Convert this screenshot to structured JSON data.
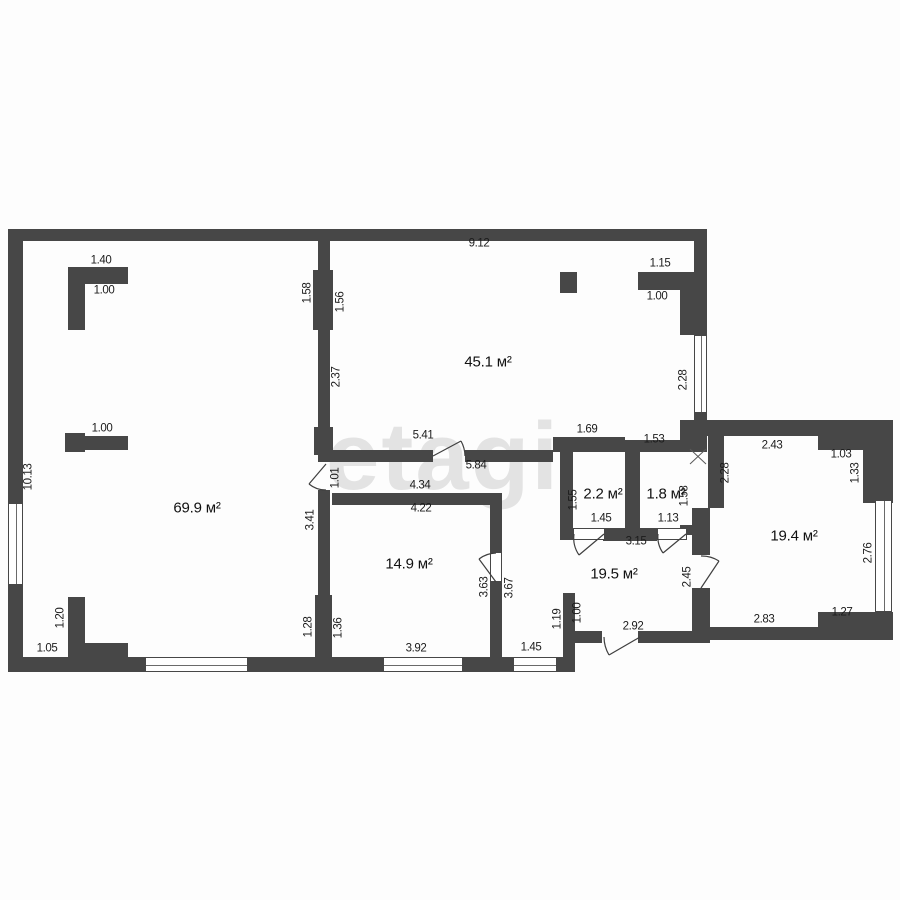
{
  "plan": {
    "wall_color": "#474747",
    "line_color": "#3f3f3f",
    "text_color": "#1c1c1c",
    "background": "#fdfdfd",
    "watermark": {
      "text": "etagi",
      "x": 443,
      "y": 457
    },
    "rooms": [
      {
        "label": "69.9 м²",
        "x": 197,
        "y": 508
      },
      {
        "label": "45.1 м²",
        "x": 488,
        "y": 362
      },
      {
        "label": "14.9 м²",
        "x": 409,
        "y": 564
      },
      {
        "label": "2.2 м²",
        "x": 603,
        "y": 494
      },
      {
        "label": "1.8 м²",
        "x": 666,
        "y": 494
      },
      {
        "label": "19.5 м²",
        "x": 614,
        "y": 574
      },
      {
        "label": "19.4 м²",
        "x": 794,
        "y": 536
      }
    ],
    "dims": [
      {
        "t": "1.40",
        "x": 101,
        "y": 261,
        "r": 0
      },
      {
        "t": "1.00",
        "x": 104,
        "y": 291,
        "r": 0
      },
      {
        "t": "9.12",
        "x": 479,
        "y": 244,
        "r": 0
      },
      {
        "t": "1.15",
        "x": 660,
        "y": 264,
        "r": 0
      },
      {
        "t": "1.00",
        "x": 657,
        "y": 297,
        "r": 0
      },
      {
        "t": "1.00",
        "x": 102,
        "y": 429,
        "r": 0
      },
      {
        "t": "1.69",
        "x": 587,
        "y": 430,
        "r": 0
      },
      {
        "t": "1.53",
        "x": 654,
        "y": 440,
        "r": 0
      },
      {
        "t": "2.43",
        "x": 772,
        "y": 446,
        "r": 0
      },
      {
        "t": "1.03",
        "x": 841,
        "y": 455,
        "r": 0
      },
      {
        "t": "5.41",
        "x": 423,
        "y": 436,
        "r": 0
      },
      {
        "t": "5.84",
        "x": 476,
        "y": 466,
        "r": 0
      },
      {
        "t": "4.34",
        "x": 420,
        "y": 486,
        "r": 0
      },
      {
        "t": "4.22",
        "x": 421,
        "y": 509,
        "r": 0
      },
      {
        "t": "1.45",
        "x": 601,
        "y": 519,
        "r": 0
      },
      {
        "t": "1.13",
        "x": 668,
        "y": 519,
        "r": 0
      },
      {
        "t": "3.15",
        "x": 636,
        "y": 542,
        "r": 0
      },
      {
        "t": "1.05",
        "x": 47,
        "y": 649,
        "r": 0
      },
      {
        "t": "3.92",
        "x": 416,
        "y": 649,
        "r": 0
      },
      {
        "t": "1.45",
        "x": 531,
        "y": 648,
        "r": 0
      },
      {
        "t": "2.92",
        "x": 633,
        "y": 627,
        "r": 0
      },
      {
        "t": "2.83",
        "x": 764,
        "y": 620,
        "r": 0
      },
      {
        "t": "1.27",
        "x": 842,
        "y": 613,
        "r": 0
      },
      {
        "t": "10.13",
        "x": 29,
        "y": 477,
        "r": 1
      },
      {
        "t": "1.58",
        "x": 308,
        "y": 293,
        "r": 1
      },
      {
        "t": "1.56",
        "x": 341,
        "y": 302,
        "r": 1
      },
      {
        "t": "2.37",
        "x": 337,
        "y": 377,
        "r": 1
      },
      {
        "t": "2.28",
        "x": 684,
        "y": 380,
        "r": 1
      },
      {
        "t": "2.28",
        "x": 726,
        "y": 473,
        "r": 1
      },
      {
        "t": "1.33",
        "x": 856,
        "y": 473,
        "r": 1
      },
      {
        "t": "2.76",
        "x": 869,
        "y": 553,
        "r": 1
      },
      {
        "t": "1.01",
        "x": 336,
        "y": 478,
        "r": 1
      },
      {
        "t": "3.41",
        "x": 311,
        "y": 520,
        "r": 1
      },
      {
        "t": "1.55",
        "x": 574,
        "y": 500,
        "r": 1
      },
      {
        "t": "1.58",
        "x": 685,
        "y": 496,
        "r": 1
      },
      {
        "t": "1.20",
        "x": 61,
        "y": 618,
        "r": 1
      },
      {
        "t": "1.28",
        "x": 309,
        "y": 627,
        "r": 1
      },
      {
        "t": "1.36",
        "x": 339,
        "y": 628,
        "r": 1
      },
      {
        "t": "3.63",
        "x": 485,
        "y": 587,
        "r": 1
      },
      {
        "t": "3.67",
        "x": 510,
        "y": 588,
        "r": 1
      },
      {
        "t": "1.19",
        "x": 558,
        "y": 619,
        "r": 1
      },
      {
        "t": "1.00",
        "x": 578,
        "y": 613,
        "r": 1
      },
      {
        "t": "2.45",
        "x": 688,
        "y": 577,
        "r": 1
      }
    ],
    "walls": [
      [
        8,
        229,
        699,
        12
      ],
      [
        8,
        229,
        15,
        274
      ],
      [
        8,
        585,
        15,
        87
      ],
      [
        8,
        657,
        567,
        15
      ],
      [
        694,
        229,
        13,
        106
      ],
      [
        694,
        413,
        13,
        10
      ],
      [
        680,
        420,
        27,
        32
      ],
      [
        700,
        420,
        118,
        16
      ],
      [
        818,
        420,
        45,
        30
      ],
      [
        863,
        420,
        30,
        83
      ],
      [
        818,
        612,
        75,
        28
      ],
      [
        700,
        627,
        118,
        13
      ],
      [
        575,
        631,
        27,
        12
      ],
      [
        638,
        631,
        72,
        12
      ],
      [
        563,
        593,
        12,
        66
      ],
      [
        318,
        240,
        12,
        32
      ],
      [
        313,
        270,
        20,
        60
      ],
      [
        318,
        330,
        12,
        100
      ],
      [
        314,
        427,
        19,
        28
      ],
      [
        68,
        267,
        60,
        17
      ],
      [
        68,
        267,
        17,
        63
      ],
      [
        560,
        272,
        17,
        21
      ],
      [
        638,
        272,
        56,
        18
      ],
      [
        680,
        290,
        27,
        45
      ],
      [
        318,
        450,
        115,
        12
      ],
      [
        465,
        450,
        88,
        12
      ],
      [
        553,
        437,
        72,
        15
      ],
      [
        625,
        440,
        57,
        12
      ],
      [
        560,
        450,
        13,
        90
      ],
      [
        625,
        440,
        15,
        100
      ],
      [
        603,
        528,
        54,
        13
      ],
      [
        680,
        525,
        14,
        10
      ],
      [
        708,
        436,
        16,
        72
      ],
      [
        692,
        508,
        18,
        47
      ],
      [
        692,
        588,
        18,
        49
      ],
      [
        332,
        493,
        170,
        12
      ],
      [
        490,
        505,
        12,
        47
      ],
      [
        490,
        582,
        12,
        80
      ],
      [
        318,
        490,
        12,
        105
      ],
      [
        315,
        595,
        17,
        62
      ],
      [
        65,
        436,
        63,
        14
      ],
      [
        65,
        433,
        20,
        19
      ],
      [
        68,
        597,
        17,
        60
      ],
      [
        68,
        643,
        60,
        14
      ]
    ],
    "windows": [
      {
        "x": 8,
        "y": 503,
        "w": 15,
        "h": 82,
        "dir": "v"
      },
      {
        "x": 145,
        "y": 657,
        "w": 103,
        "h": 15,
        "dir": "h"
      },
      {
        "x": 383,
        "y": 657,
        "w": 80,
        "h": 15,
        "dir": "h"
      },
      {
        "x": 513,
        "y": 657,
        "w": 44,
        "h": 15,
        "dir": "h"
      },
      {
        "x": 694,
        "y": 335,
        "w": 13,
        "h": 78,
        "dir": "v"
      },
      {
        "x": 875,
        "y": 500,
        "w": 17,
        "h": 112,
        "dir": "v"
      }
    ],
    "sills": [
      [
        573,
        528,
        32,
        12
      ],
      [
        657,
        528,
        30,
        12
      ],
      [
        490,
        552,
        12,
        30
      ]
    ],
    "doors": [
      "M433,456 L461,441 M465,456 A32,32 0 0 0 461,441",
      "M326,464 L309,484 M326,490 A26,26 0 0 1 309,484",
      "M604,534 L579,555 M574,534 A30,30 0 0 0 579,555",
      "M686,534 L663,553 M658,534 A28,28 0 0 0 663,553",
      "M496,582 L479,559 M496,553 A29,29 0 0 0 479,559",
      "M701,588 L719,561 M701,556 A32,32 0 0 1 719,561",
      "M640,637 L609,655 M604,637 A36,36 0 0 0 609,655"
    ],
    "hatches": [
      "M690,449 L706,464 M706,449 L690,464"
    ]
  }
}
